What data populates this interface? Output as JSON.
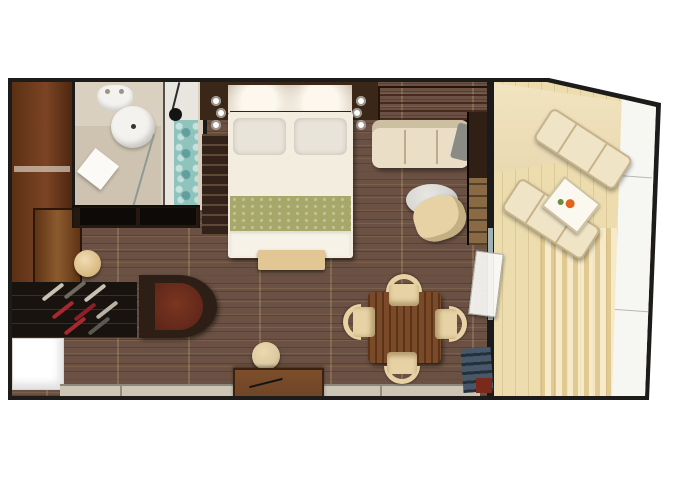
{
  "meta": {
    "kind": "floor-plan",
    "subject": "cruise-ship-balcony-suite-stateroom",
    "render_style": "top-down-3d",
    "visible_text": "none"
  },
  "palette": {
    "frame": "#1e1c1a",
    "floor_wood": "#6b5144",
    "entry_wood": "#7c4424",
    "door_wood": "#8c5a2e",
    "bath_floor": "#d9d0c0",
    "bath_white": "#f4f2ee",
    "shower_tile": "#8fc4bd",
    "headboard_wall": "#3a2718",
    "mirror_light": "#d8cdbd",
    "accent_blue": "#235a74",
    "bed_linen": "#f2edde",
    "pillow": "#e9e4da",
    "runner_green": "#a6a768",
    "bench_tan": "#e2c795",
    "shelf_orange": "#f0a050",
    "sofa_cream": "#eadfc6",
    "table_gray": "#d7d6d2",
    "chair_tan": "#e6d2a4",
    "dining_wood": "#7b4a28",
    "desk_wood": "#6f4526",
    "stool_tan": "#dcc9a0",
    "window_band": "#cdc5b6",
    "wine_rack": "#191310",
    "vanity_red": "#5a2218",
    "balcony_deck": "#ecdcae",
    "balcony_over": "#f1e4c0",
    "hull_white": "#f6f6f2",
    "lounger_cream": "#f0e4c6",
    "slate_blue": "#46586a",
    "drink_orange": "#e0641e"
  },
  "rooms": [
    {
      "id": "entry",
      "label": "entry hall with wardrobe and door"
    },
    {
      "id": "bathroom",
      "label": "bathroom with toilet, round sink, tiled shower"
    },
    {
      "id": "bedroom",
      "label": "bedroom with double bed, headboard wall, sconces"
    },
    {
      "id": "living",
      "label": "living area with sofa, coffee table, armchair, TV cabinet"
    },
    {
      "id": "dining",
      "label": "dining area with square table and four chairs, desk with stool"
    },
    {
      "id": "storage",
      "label": "storage wall with bottle rack, curved vanity unit"
    },
    {
      "id": "balcony",
      "label": "angled private balcony with two loungers and side table"
    }
  ],
  "furniture": [
    {
      "room": "entry",
      "item": "entry-door"
    },
    {
      "room": "entry",
      "item": "wardrobe"
    },
    {
      "room": "entry",
      "item": "round-stool"
    },
    {
      "room": "bathroom",
      "item": "toilet"
    },
    {
      "room": "bathroom",
      "item": "round-sink"
    },
    {
      "room": "bathroom",
      "item": "shower-mosaic-tile"
    },
    {
      "room": "bathroom",
      "item": "shower-head"
    },
    {
      "room": "bedroom",
      "item": "double-bed"
    },
    {
      "room": "bedroom",
      "item": "pillow-left"
    },
    {
      "room": "bedroom",
      "item": "pillow-right"
    },
    {
      "room": "bedroom",
      "item": "green-bed-runner"
    },
    {
      "room": "bedroom",
      "item": "foot-bench"
    },
    {
      "room": "bedroom",
      "item": "wall-sconces"
    },
    {
      "room": "bedroom",
      "item": "closet"
    },
    {
      "room": "living",
      "item": "luggage-shelf"
    },
    {
      "room": "living",
      "item": "sofa"
    },
    {
      "room": "living",
      "item": "round-coffee-table"
    },
    {
      "room": "living",
      "item": "armchair"
    },
    {
      "room": "living",
      "item": "tv-cabinet"
    },
    {
      "room": "dining",
      "item": "square-dining-table"
    },
    {
      "room": "dining",
      "item": "dining-chairs-x4"
    },
    {
      "room": "dining",
      "item": "writing-desk"
    },
    {
      "room": "dining",
      "item": "desk-stool"
    },
    {
      "room": "storage",
      "item": "bottle-rack"
    },
    {
      "room": "storage",
      "item": "curved-vanity"
    },
    {
      "room": "balcony",
      "item": "lounger-1"
    },
    {
      "room": "balcony",
      "item": "lounger-2"
    },
    {
      "room": "balcony",
      "item": "side-table-with-drink"
    },
    {
      "room": "balcony",
      "item": "glass-door"
    }
  ]
}
